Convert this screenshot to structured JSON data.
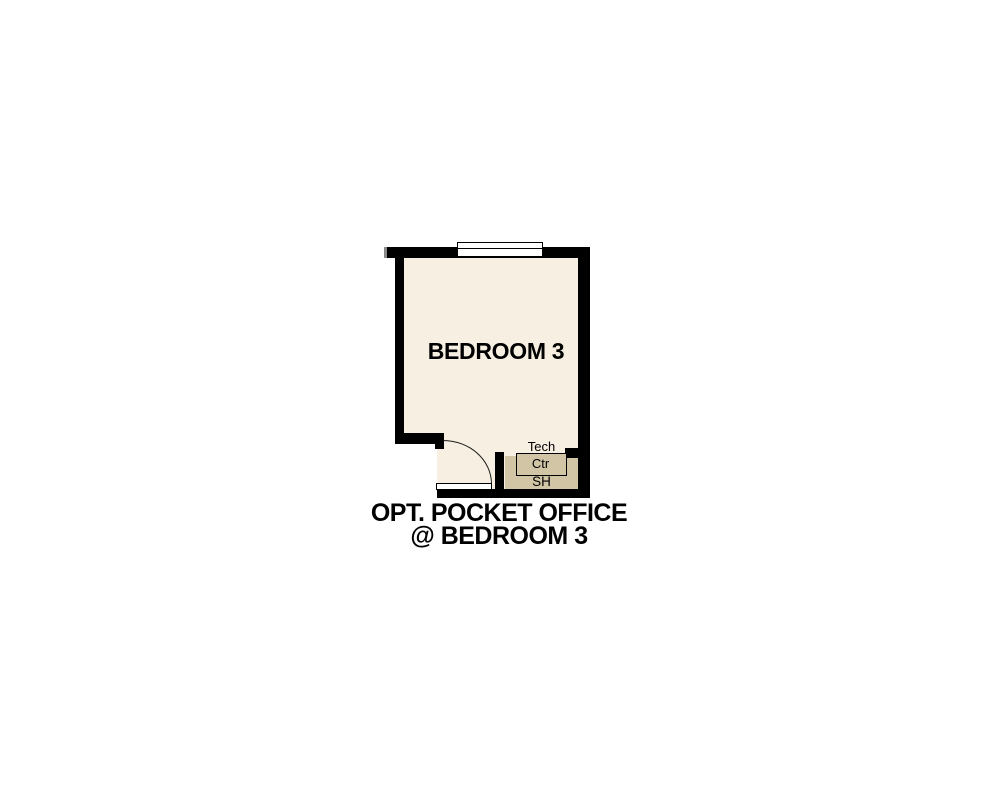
{
  "plan": {
    "room_label": "BEDROOM 3",
    "tech_label": "Tech",
    "ctr_label": "Ctr",
    "sh_label": "SH"
  },
  "caption": {
    "line1": "OPT. POCKET OFFICE",
    "line2": "@ BEDROOM 3"
  },
  "colors": {
    "background": "#ffffff",
    "wall": "#000000",
    "room_fill": "#f7efe2",
    "counter_fill": "#d2c5a6",
    "text": "#000000"
  }
}
